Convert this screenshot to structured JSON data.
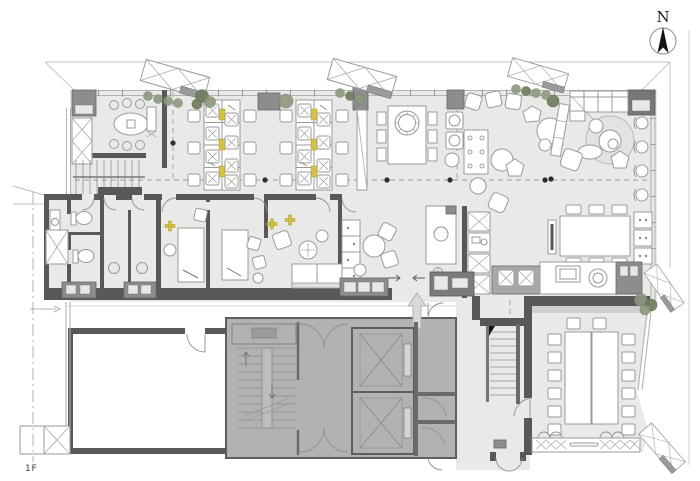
{
  "floor_label": "1F",
  "compass_label": "N",
  "colors": {
    "floor": "#e9e9e8",
    "wall-dark": "#585858",
    "wall-mid": "#8d8d8d",
    "core-fill": "#b2b2b1",
    "glazing": "#b3b3b3",
    "furniture-stroke": "#9a9a9a",
    "plant-green": "#8e987e",
    "plant-dark": "#707d5f",
    "accent-yellow": "#d4c343",
    "arrow-fill": "#d9d9d9",
    "dashed-line": "#9b9b9b",
    "label-text": "#3c3c3c"
  }
}
